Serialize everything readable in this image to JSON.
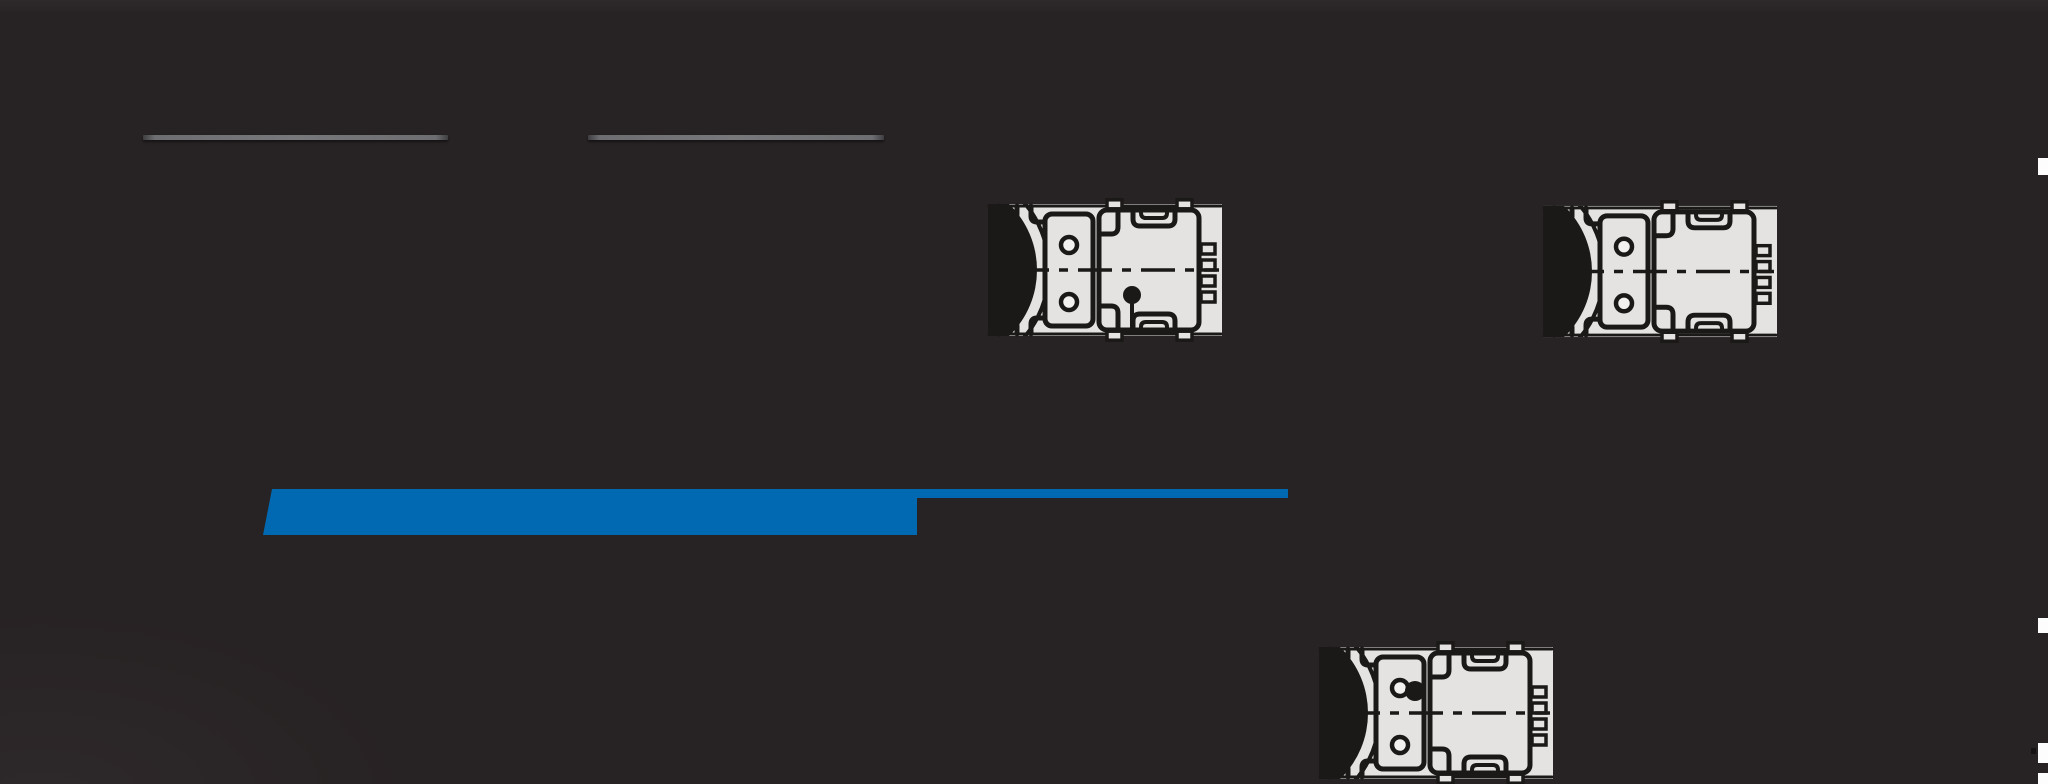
{
  "canvas": {
    "width": 2048,
    "height": 784,
    "background_color": "#272223",
    "top_band_color": "#2e2a2b"
  },
  "skeleton_lines": {
    "color": "#6d6e71",
    "items": [
      {
        "x": 143,
        "y": 135,
        "w": 305,
        "h": 5
      },
      {
        "x": 588,
        "y": 135,
        "w": 296,
        "h": 5
      }
    ]
  },
  "progress": {
    "accent_color": "#0069b1",
    "bar": {
      "x": 263,
      "y": 489,
      "w": 654,
      "h": 46,
      "top_left_slant": 9
    },
    "track": {
      "x": 917,
      "y": 489,
      "w": 371,
      "h": 9
    }
  },
  "drawings": {
    "plate_color": "#e4e3e2",
    "line_color": "#1b1918",
    "hole_color": "#f2f1f0",
    "items": [
      {
        "name": "gearmotor-top-view-1",
        "x": 987,
        "y": 198,
        "w": 236,
        "h": 144,
        "plug_dot": "housing"
      },
      {
        "name": "gearmotor-top-view-2",
        "x": 1542,
        "y": 200,
        "w": 236,
        "h": 143,
        "plug_dot": "none"
      },
      {
        "name": "gearmotor-top-view-3",
        "x": 1318,
        "y": 641,
        "w": 236,
        "h": 144,
        "plug_dot": "flange"
      }
    ]
  },
  "edge_fragments": {
    "color": "#fdfdfd",
    "items": [
      {
        "x": 2038,
        "y": 158,
        "w": 10,
        "h": 17
      },
      {
        "x": 2038,
        "y": 618,
        "w": 10,
        "h": 15
      },
      {
        "x": 2038,
        "y": 743,
        "w": 10,
        "h": 20
      },
      {
        "x": 2038,
        "y": 773,
        "w": 10,
        "h": 11
      }
    ],
    "speck": {
      "x": 2031,
      "y": 748,
      "w": 5,
      "h": 6
    }
  }
}
